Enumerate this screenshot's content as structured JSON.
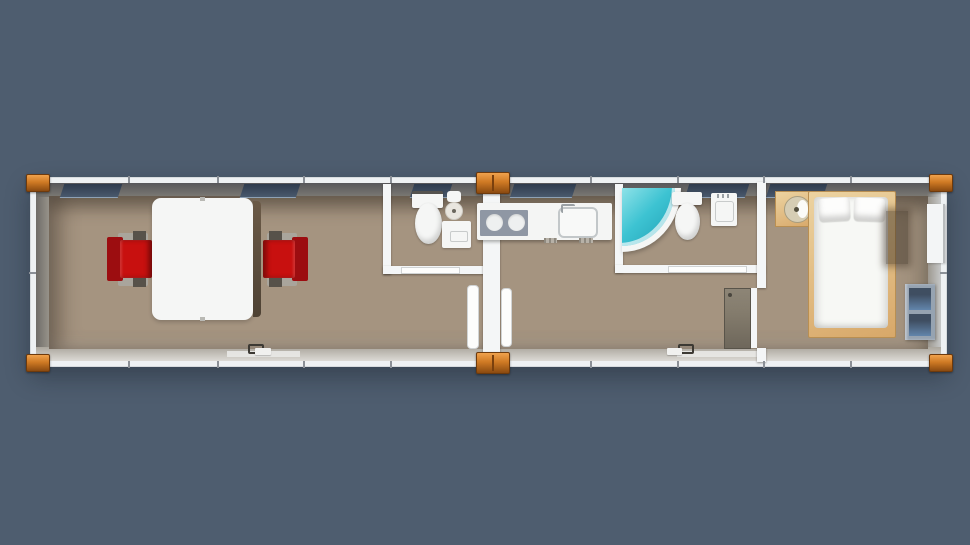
{
  "scene": {
    "kind": "3d-top-down-floor-plan-render",
    "subject": "two-module prefab container house",
    "modules": [
      {
        "name": "module-left",
        "rooms": [
          "meeting-room",
          "bathroom-1"
        ]
      },
      {
        "name": "module-right",
        "rooms": [
          "kitchen",
          "bathroom-2",
          "living-area",
          "bedroom"
        ]
      }
    ],
    "fixtures": {
      "meeting-room": [
        "white-table",
        "red-chair-left",
        "red-chair-right",
        "entry-door"
      ],
      "bathroom-1": [
        "toilet",
        "round-wall-basin",
        "shower-tray",
        "door"
      ],
      "kitchen": [
        "counter",
        "two-burner-stove",
        "inset-sink",
        "base-grilles"
      ],
      "bathroom-2": [
        "corner-bathtub",
        "toilet",
        "wall-sink",
        "door"
      ],
      "living-area": [
        "open-bedroom-door",
        "entry-door"
      ],
      "bedroom": [
        "wood-washstand",
        "double-bed",
        "two-pillows",
        "wall-shelf",
        "blue-storage-cabinet"
      ]
    },
    "window_count": 6,
    "corner_casting_count": 6
  },
  "palette": {
    "bg": "#4e5d6f",
    "frame_white": "#eef1f3",
    "partition_white": "#f4f6f7",
    "wall_face_dark": "#7c7a74",
    "wall_face_mid": "#9a958c",
    "wall_face_light": "#aba69d",
    "floor_tan": "#a59480",
    "casting_orange": "#cf7a24",
    "casting_dark": "#8a4a10",
    "casting_light": "#f0a24d",
    "chair_red": "#c8100f",
    "chair_red_dark": "#9c0d10",
    "armrest_gray": "#a9a59c",
    "counter_white": "#f4f5f4",
    "stove_gray": "#8f97a4",
    "burner_white": "#eef0f0",
    "tub_teal": "#3dc3d2",
    "tub_teal_deep": "#1f9fb4",
    "fixture_white": "#f5f6f5",
    "wood": "#d8a869",
    "wood_light": "#ecd3a1",
    "cabinet_frame": "#96a3b1",
    "cabinet_panel_dark": "#3f4e61",
    "cabinet_panel": "#6285ab",
    "window_glass": "#49596d",
    "door_leaf_gray": "#847c6d"
  }
}
